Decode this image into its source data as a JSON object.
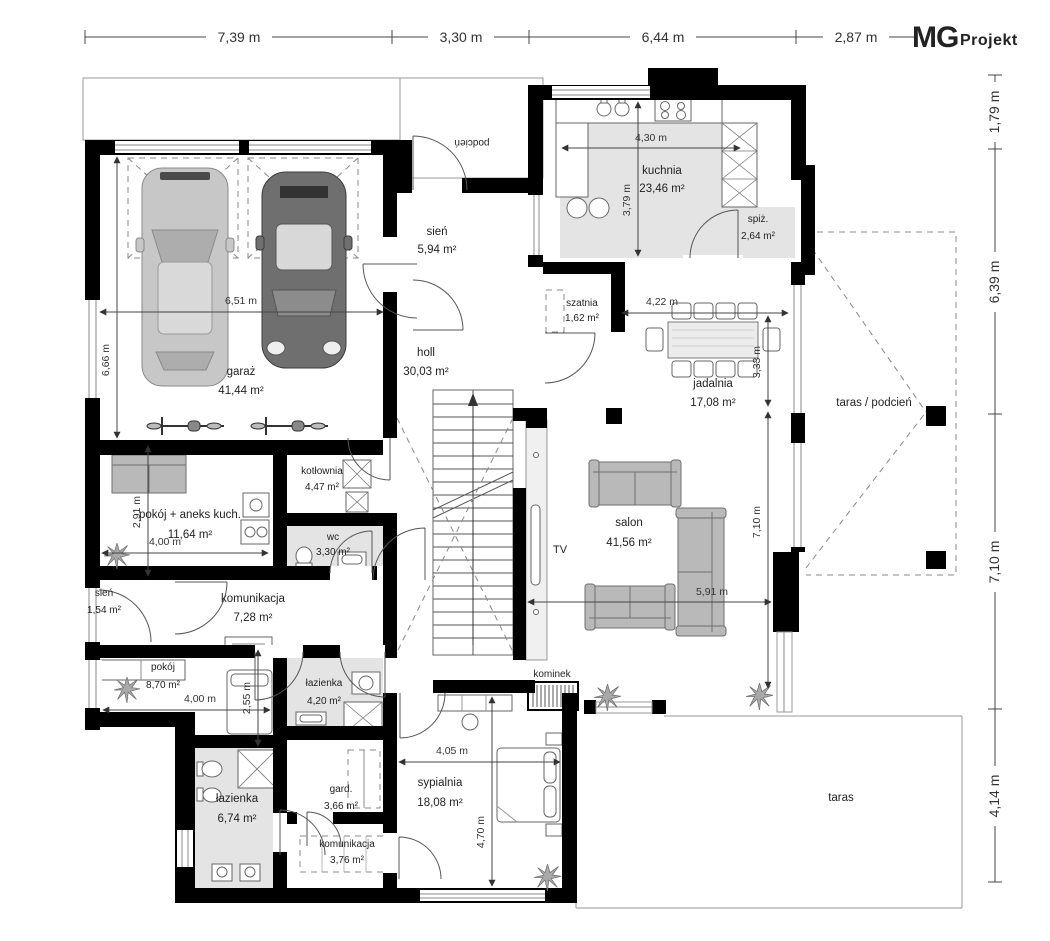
{
  "logo": {
    "mg": "MG",
    "projekt": "Projekt"
  },
  "dims": {
    "top": [
      "7,39 m",
      "3,30 m",
      "6,44 m",
      "2,87 m"
    ],
    "right": [
      "1,79 m",
      "6,39 m",
      "7,10 m",
      "4,14 m"
    ],
    "garage_w": "6,51 m",
    "garage_h": "6,66 m",
    "kitchen_w": "4,30 m",
    "kitchen_h": "3,79 m",
    "dining_w": "4,22 m",
    "dining_h": "3,33 m",
    "salon_h": "7,10 m",
    "salon_w": "5,91 m",
    "aneks_h": "2,91 m",
    "aneks_w": "4,00 m",
    "pokoj_w": "4,00 m",
    "pokoj_h": "2,55 m",
    "sypialnia_w": "4,05 m",
    "sypialnia_h": "4,70 m"
  },
  "rooms": {
    "garaz": {
      "name": "garaż",
      "area": "41,44 m²"
    },
    "sien1": {
      "name": "sień",
      "area": "5,94 m²"
    },
    "kuchnia": {
      "name": "kuchnia",
      "area": "23,46 m²"
    },
    "spiz": {
      "name": "spiż.",
      "area": "2,64 m²"
    },
    "szatnia": {
      "name": "szatnia",
      "area": "1,62 m²"
    },
    "holl": {
      "name": "holl",
      "area": "30,03 m²"
    },
    "jadalnia": {
      "name": "jadalnia",
      "area": "17,08 m²"
    },
    "kotlownia": {
      "name": "kotłownia",
      "area": "4,47 m²"
    },
    "aneks": {
      "name": "pokój + aneks kuch.",
      "area": "11,64 m²"
    },
    "wc": {
      "name": "wc",
      "area": "3,30 m²"
    },
    "salon": {
      "name": "salon",
      "area": "41,56 m²"
    },
    "sien2": {
      "name": "sień",
      "area": "1,54 m²"
    },
    "komunikacja1": {
      "name": "komunikacja",
      "area": "7,28 m²"
    },
    "pokoj": {
      "name": "pokój",
      "area": "8,70 m²"
    },
    "lazienka1": {
      "name": "łazienka",
      "area": "4,20 m²"
    },
    "lazienka2": {
      "name": "łazienka",
      "area": "6,74 m²"
    },
    "gard": {
      "name": "gard.",
      "area": "3,66 m²"
    },
    "sypialnia": {
      "name": "sypialnia",
      "area": "18,08 m²"
    },
    "komunikacja2": {
      "name": "komunikacja",
      "area": "3,76 m²"
    }
  },
  "labels": {
    "taras_podcien": "taras / podcień",
    "taras": "taras",
    "podcien": "podcień",
    "kominek": "kominek",
    "tv": "TV"
  }
}
